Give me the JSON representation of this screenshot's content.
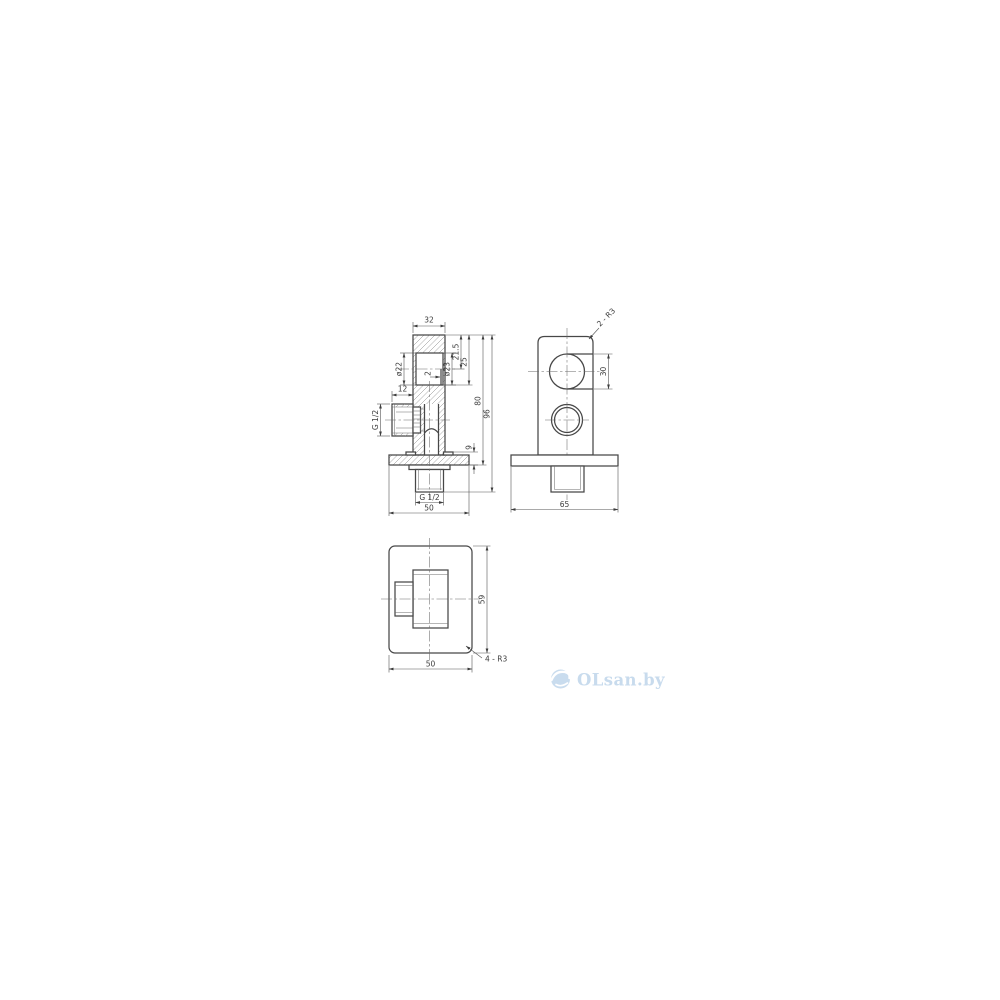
{
  "drawing": {
    "front": {
      "w32": "32",
      "l12": "12",
      "thread_side": "G 1/2",
      "d22": "ø22",
      "d23": "ø23",
      "step2": "2",
      "d215": "21.5",
      "d25": "25",
      "d80": "80",
      "d96": "96",
      "d9": "9",
      "thread_bottom": "G 1/2",
      "w50": "50"
    },
    "side": {
      "r_top": "2 - R3",
      "d30": "30",
      "w65": "65"
    },
    "plan": {
      "h59": "59",
      "w50": "50",
      "r_corners": "4 - R3"
    }
  },
  "watermark": {
    "brand": "OLsan.by",
    "logo_color": "#c9dcee",
    "text_color": "#c8dbed"
  },
  "colors": {
    "line": "#474747",
    "thin": "#6e6e6e",
    "text": "#3c3c3c"
  }
}
